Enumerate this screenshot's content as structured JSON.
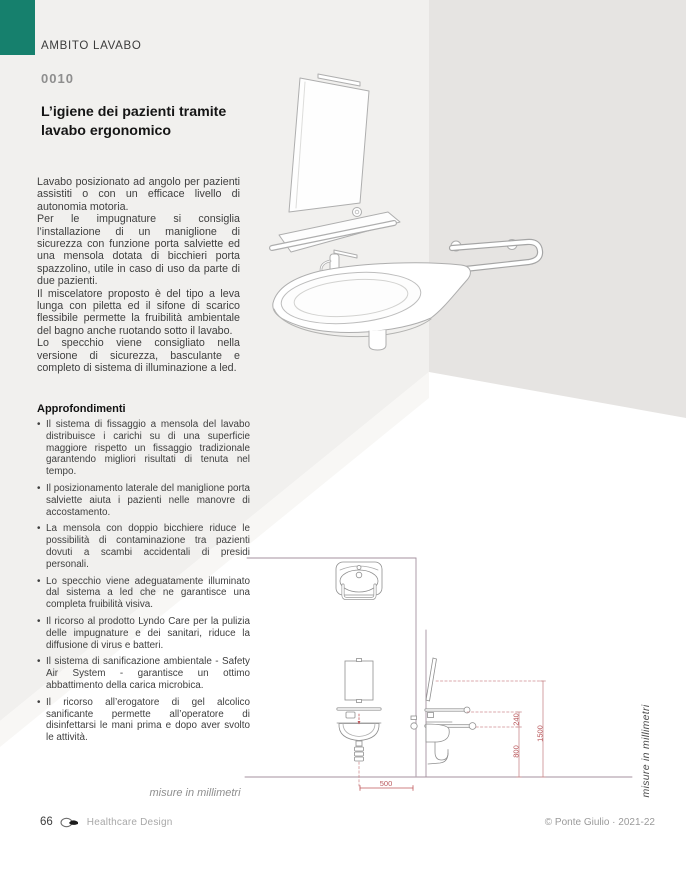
{
  "colors": {
    "teal": "#16806d",
    "dimension_red": "#c0575b",
    "wall_line": "#a4919f"
  },
  "header": {
    "section": "AMBITO LAVABO",
    "code": "0010",
    "title": "L’igiene dei pazienti tramite lavabo ergonomico"
  },
  "intro": {
    "paragraphs": [
      "Lavabo posizionato ad angolo per pazienti assistiti o con un efficace livello di autonomia motoria.",
      "Per le impugnature si consiglia l’installazione di un maniglione di sicurezza con funzione porta salviette ed una mensola dotata di bicchieri porta spazzolino, utile in caso di uso da parte di due pazienti.",
      "Il miscelatore proposto è del tipo a leva lunga con piletta ed il sifone di scarico flessibile permette la fruibilità ambientale del bagno anche ruotando sotto il lavabo.",
      "Lo specchio viene consigliato nella versione di sicurezza, basculante e completo di sistema di illuminazione a led."
    ]
  },
  "insights": {
    "heading": "Approfondimenti",
    "bullets": [
      "Il sistema di fissaggio a mensola del lavabo distribuisce i carichi su di una superficie maggiore rispetto un fissaggio tradizionale garantendo migliori risultati di tenuta nel tempo.",
      "Il posizionamento laterale del maniglione porta salviette aiuta i pazienti nelle manovre di accostamento.",
      "La mensola con doppio bicchiere riduce le possibilità di contaminazione tra pazienti dovuti a scambi accidentali di presidi personali.",
      "Lo specchio viene adeguatamente illuminato dal sistema a led che ne garantisce una completa fruibilità visiva.",
      "Il ricorso al prodotto Lyndo Care per la pulizia delle impugnature e dei sanitari, riduce la diffusione di virus e batteri.",
      "Il sistema di sanificazione ambientale - Safety Air System - garantisce un ottimo abbattimento della carica microbica.",
      "Il ricorso all’erogatore di gel alcolico sanificante permette all’operatore di disinfettarsi le mani prima e dopo aver svolto le attività."
    ]
  },
  "drawing": {
    "caption": "misure in millimetri",
    "side_caption": "misure in millimetri",
    "dim_500": "500",
    "dim_240": "240",
    "dim_800": "800",
    "dim_1500": "1500"
  },
  "footer": {
    "page_number": "66",
    "brand": "Healthcare Design",
    "copyright": "© Ponte Giulio · 2021-22"
  }
}
